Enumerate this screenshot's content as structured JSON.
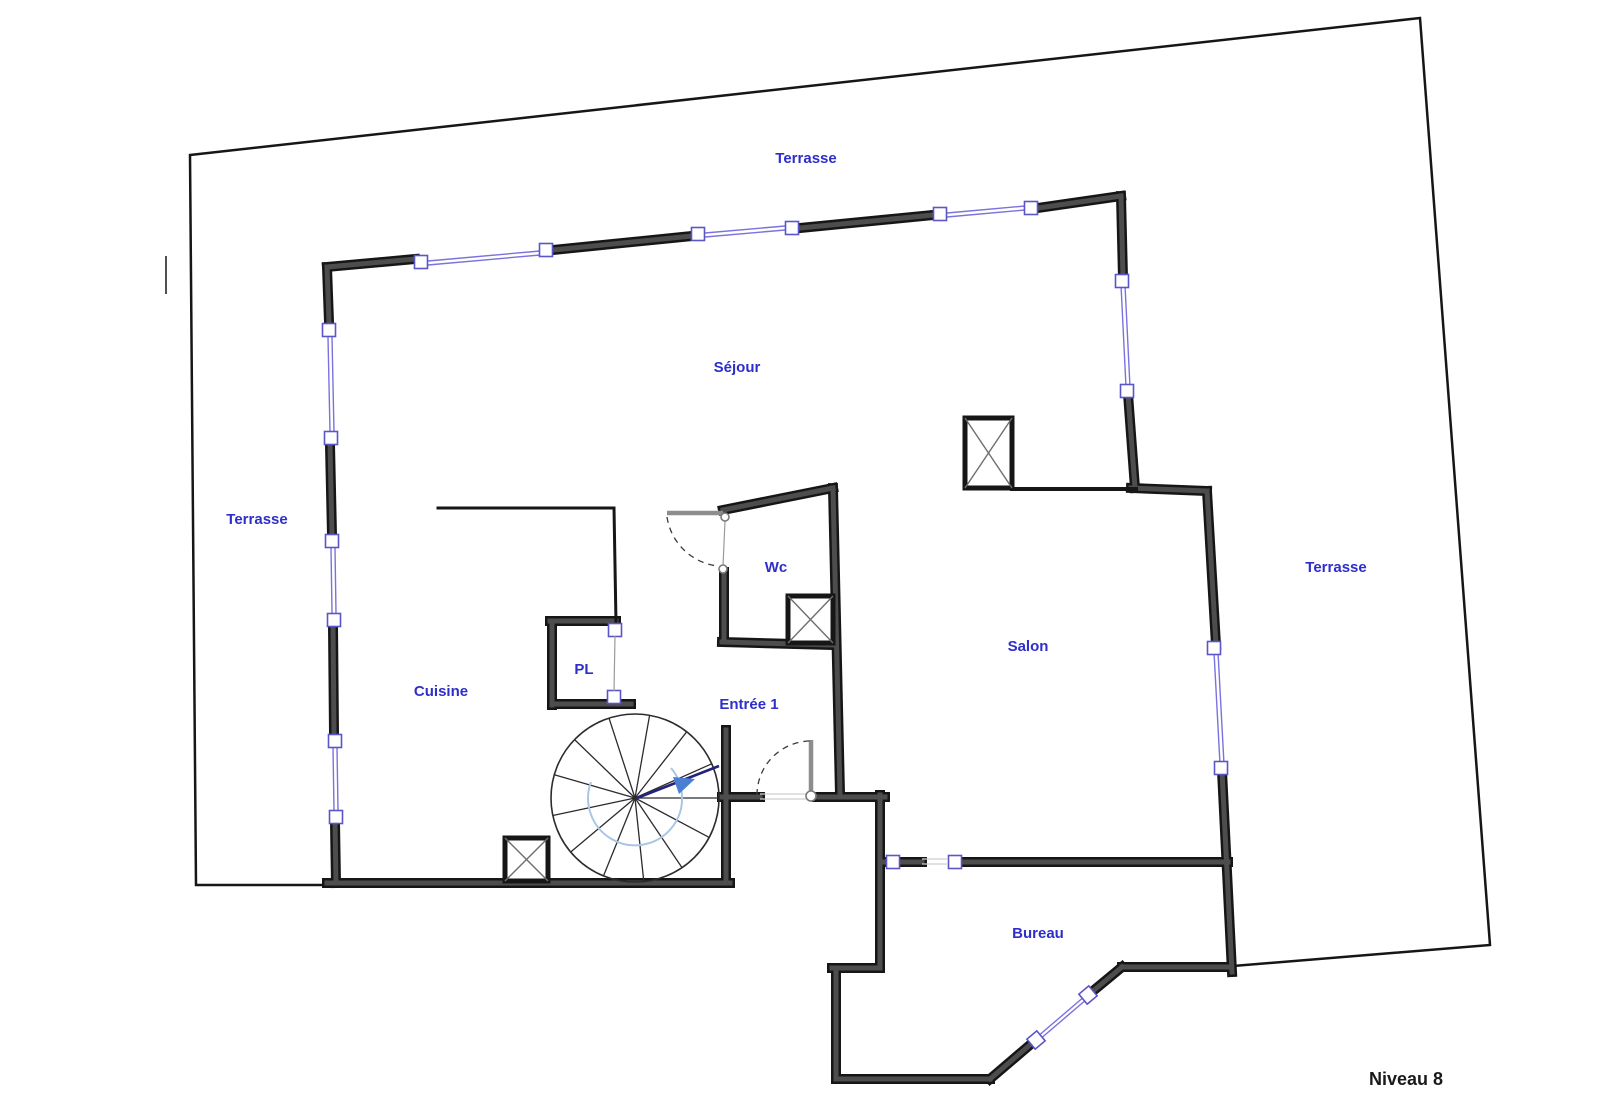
{
  "page": {
    "background": "#ffffff",
    "level_caption": "Niveau 8"
  },
  "labels": {
    "terrasse_top": "Terrasse",
    "terrasse_left": "Terrasse",
    "terrasse_right": "Terrasse",
    "sejour": "Séjour",
    "wc": "Wc",
    "salon": "Salon",
    "cuisine": "Cuisine",
    "pl": "PL",
    "entree": "Entrée 1",
    "bureau": "Bureau",
    "level": "Niveau 8"
  },
  "colors": {
    "background": "#ffffff",
    "label_blue": "#2e2ecb",
    "title_dark": "#1a1a1a",
    "wall_dark": "#4d4d4d",
    "wall_edge": "#161616",
    "outer_boundary": "#161616",
    "window_blue": "#7b72dd",
    "window_mullion": "#5a55c8",
    "door_gray": "#8d8d8d",
    "stair_accent_blue": "#a9c6e4",
    "stair_dir_blue": "#23237a",
    "stair_arrow_blue": "#4a7fd4"
  }
}
